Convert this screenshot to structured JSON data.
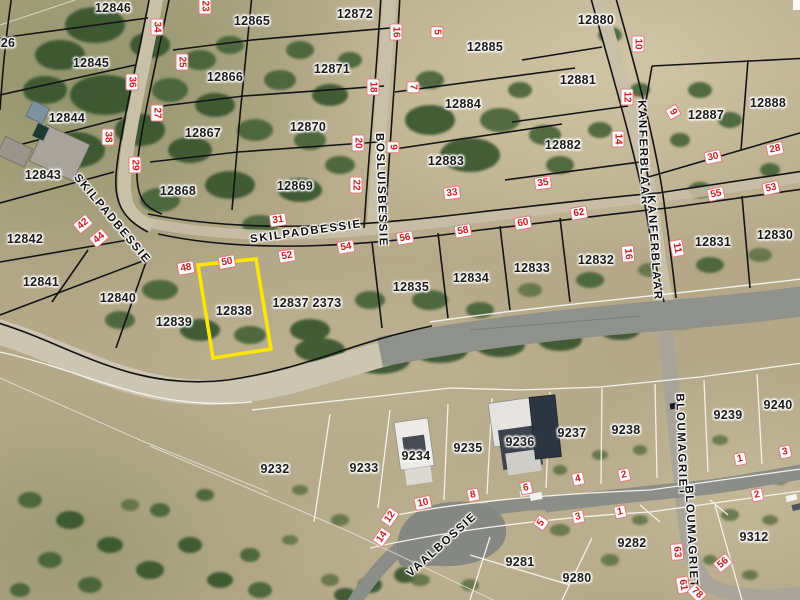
{
  "map": {
    "type": "aerial-cadastral-map",
    "highlighted_parcel": "12838",
    "colors": {
      "highlight": "#ffe600",
      "lot_number_red": "#c81e1e",
      "boundary_top": "#141414",
      "boundary_bottom": "#f7f5ef",
      "tar_road": "#8e918c",
      "gravel_road": "#ccc5b2"
    },
    "parcel_labels": [
      {
        "label": "26",
        "x": 8,
        "y": 43
      },
      {
        "label": "12846",
        "x": 113,
        "y": 8
      },
      {
        "label": "12865",
        "x": 252,
        "y": 21
      },
      {
        "label": "12872",
        "x": 355,
        "y": 14
      },
      {
        "label": "12880",
        "x": 596,
        "y": 20
      },
      {
        "label": "12885",
        "x": 485,
        "y": 47
      },
      {
        "label": "12845",
        "x": 91,
        "y": 63
      },
      {
        "label": "12866",
        "x": 225,
        "y": 77
      },
      {
        "label": "12871",
        "x": 332,
        "y": 69
      },
      {
        "label": "12881",
        "x": 578,
        "y": 80
      },
      {
        "label": "12888",
        "x": 768,
        "y": 103
      },
      {
        "label": "12887",
        "x": 706,
        "y": 115
      },
      {
        "label": "12844",
        "x": 67,
        "y": 118
      },
      {
        "label": "12884",
        "x": 463,
        "y": 104
      },
      {
        "label": "12867",
        "x": 203,
        "y": 133
      },
      {
        "label": "12870",
        "x": 308,
        "y": 127
      },
      {
        "label": "12882",
        "x": 563,
        "y": 145
      },
      {
        "label": "12843",
        "x": 43,
        "y": 175
      },
      {
        "label": "12868",
        "x": 178,
        "y": 191
      },
      {
        "label": "12869",
        "x": 295,
        "y": 186
      },
      {
        "label": "12883",
        "x": 446,
        "y": 161
      },
      {
        "label": "12842",
        "x": 25,
        "y": 239
      },
      {
        "label": "12841",
        "x": 41,
        "y": 282
      },
      {
        "label": "12830",
        "x": 775,
        "y": 235
      },
      {
        "label": "12831",
        "x": 713,
        "y": 242
      },
      {
        "label": "12832",
        "x": 596,
        "y": 260
      },
      {
        "label": "12833",
        "x": 532,
        "y": 268
      },
      {
        "label": "12834",
        "x": 471,
        "y": 278
      },
      {
        "label": "12835",
        "x": 411,
        "y": 287
      },
      {
        "label": "12840",
        "x": 118,
        "y": 298
      },
      {
        "label": "12839",
        "x": 174,
        "y": 322
      },
      {
        "label": "12838",
        "x": 234,
        "y": 311
      },
      {
        "label": "12837 2373",
        "x": 307,
        "y": 303
      },
      {
        "label": "9232",
        "x": 275,
        "y": 469
      },
      {
        "label": "9233",
        "x": 364,
        "y": 468
      },
      {
        "label": "9234",
        "x": 416,
        "y": 456
      },
      {
        "label": "9235",
        "x": 468,
        "y": 448
      },
      {
        "label": "9236",
        "x": 520,
        "y": 442
      },
      {
        "label": "9237",
        "x": 572,
        "y": 433
      },
      {
        "label": "9238",
        "x": 626,
        "y": 430
      },
      {
        "label": "9239",
        "x": 728,
        "y": 415
      },
      {
        "label": "9240",
        "x": 778,
        "y": 405
      },
      {
        "label": "9281",
        "x": 520,
        "y": 562
      },
      {
        "label": "9282",
        "x": 632,
        "y": 543
      },
      {
        "label": "9280",
        "x": 577,
        "y": 578
      },
      {
        "label": "9312",
        "x": 754,
        "y": 537
      }
    ],
    "street_labels": [
      {
        "label": "SKILPADBESSIE",
        "x": 112,
        "y": 219,
        "rot": 50
      },
      {
        "label": "SKILPADBESSIE",
        "x": 306,
        "y": 232,
        "rot": -8
      },
      {
        "label": "BOSLUISBESSIE",
        "x": 381,
        "y": 190,
        "rot": 88
      },
      {
        "label": "KANFERBLAAR",
        "x": 643,
        "y": 153,
        "rot": 88
      },
      {
        "label": "KANFERBLAAR",
        "x": 654,
        "y": 248,
        "rot": 86
      },
      {
        "label": "VAALBOSSIE",
        "x": 442,
        "y": 545,
        "rot": -42
      },
      {
        "label": "BLOUMAGRIET",
        "x": 681,
        "y": 445,
        "rot": 88
      },
      {
        "label": "BLOUMAGRIET",
        "x": 691,
        "y": 537,
        "rot": 87
      }
    ],
    "lot_numbers": [
      {
        "label": "23",
        "x": 205,
        "y": 6,
        "rot": 90
      },
      {
        "label": "34",
        "x": 157,
        "y": 27,
        "rot": 90
      },
      {
        "label": "25",
        "x": 182,
        "y": 62,
        "rot": 90
      },
      {
        "label": "36",
        "x": 132,
        "y": 82,
        "rot": 90
      },
      {
        "label": "27",
        "x": 157,
        "y": 113,
        "rot": 90
      },
      {
        "label": "38",
        "x": 108,
        "y": 137,
        "rot": 90
      },
      {
        "label": "29",
        "x": 135,
        "y": 165,
        "rot": 90
      },
      {
        "label": "16",
        "x": 396,
        "y": 32,
        "rot": 90
      },
      {
        "label": "5",
        "x": 437,
        "y": 32,
        "rot": 90
      },
      {
        "label": "18",
        "x": 373,
        "y": 87,
        "rot": 90
      },
      {
        "label": "7",
        "x": 413,
        "y": 87,
        "rot": 90
      },
      {
        "label": "20",
        "x": 358,
        "y": 143,
        "rot": 90
      },
      {
        "label": "9",
        "x": 393,
        "y": 147,
        "rot": 90
      },
      {
        "label": "22",
        "x": 356,
        "y": 185,
        "rot": 90
      },
      {
        "label": "10",
        "x": 638,
        "y": 44,
        "rot": 90
      },
      {
        "label": "12",
        "x": 627,
        "y": 97,
        "rot": 90
      },
      {
        "label": "14",
        "x": 618,
        "y": 139,
        "rot": 90
      },
      {
        "label": "9",
        "x": 673,
        "y": 112,
        "rot": 60
      },
      {
        "label": "16",
        "x": 628,
        "y": 254,
        "rot": 85
      },
      {
        "label": "11",
        "x": 677,
        "y": 248,
        "rot": 80
      },
      {
        "label": "31",
        "x": 278,
        "y": 220,
        "rot": -8
      },
      {
        "label": "33",
        "x": 452,
        "y": 193,
        "rot": -8
      },
      {
        "label": "35",
        "x": 543,
        "y": 183,
        "rot": -8
      },
      {
        "label": "42",
        "x": 83,
        "y": 224,
        "rot": -40
      },
      {
        "label": "44",
        "x": 99,
        "y": 238,
        "rot": -40
      },
      {
        "label": "48",
        "x": 186,
        "y": 268,
        "rot": -10
      },
      {
        "label": "50",
        "x": 227,
        "y": 262,
        "rot": -10
      },
      {
        "label": "52",
        "x": 287,
        "y": 256,
        "rot": -10
      },
      {
        "label": "54",
        "x": 346,
        "y": 247,
        "rot": -10
      },
      {
        "label": "56",
        "x": 405,
        "y": 238,
        "rot": -10
      },
      {
        "label": "58",
        "x": 463,
        "y": 231,
        "rot": -10
      },
      {
        "label": "60",
        "x": 523,
        "y": 223,
        "rot": -10
      },
      {
        "label": "62",
        "x": 579,
        "y": 213,
        "rot": -10
      },
      {
        "label": "30",
        "x": 713,
        "y": 157,
        "rot": -12
      },
      {
        "label": "28",
        "x": 775,
        "y": 149,
        "rot": -12
      },
      {
        "label": "53",
        "x": 771,
        "y": 188,
        "rot": -12
      },
      {
        "label": "55",
        "x": 716,
        "y": 194,
        "rot": -12
      },
      {
        "label": "14",
        "x": 382,
        "y": 537,
        "rot": -55
      },
      {
        "label": "12",
        "x": 390,
        "y": 517,
        "rot": -55
      },
      {
        "label": "10",
        "x": 423,
        "y": 503,
        "rot": -12
      },
      {
        "label": "8",
        "x": 473,
        "y": 495,
        "rot": -12
      },
      {
        "label": "6",
        "x": 526,
        "y": 488,
        "rot": -12
      },
      {
        "label": "4",
        "x": 578,
        "y": 479,
        "rot": -12
      },
      {
        "label": "2",
        "x": 624,
        "y": 475,
        "rot": -12
      },
      {
        "label": "1",
        "x": 740,
        "y": 459,
        "rot": -12
      },
      {
        "label": "3",
        "x": 785,
        "y": 452,
        "rot": -12
      },
      {
        "label": "2",
        "x": 757,
        "y": 495,
        "rot": -12
      },
      {
        "label": "5",
        "x": 541,
        "y": 523,
        "rot": -55
      },
      {
        "label": "3",
        "x": 578,
        "y": 517,
        "rot": -12
      },
      {
        "label": "1",
        "x": 620,
        "y": 512,
        "rot": -12
      },
      {
        "label": "63",
        "x": 677,
        "y": 552,
        "rot": 85
      },
      {
        "label": "56",
        "x": 723,
        "y": 563,
        "rot": -40
      },
      {
        "label": "61",
        "x": 683,
        "y": 585,
        "rot": 80
      },
      {
        "label": "78",
        "x": 697,
        "y": 593,
        "rot": 45
      }
    ]
  }
}
